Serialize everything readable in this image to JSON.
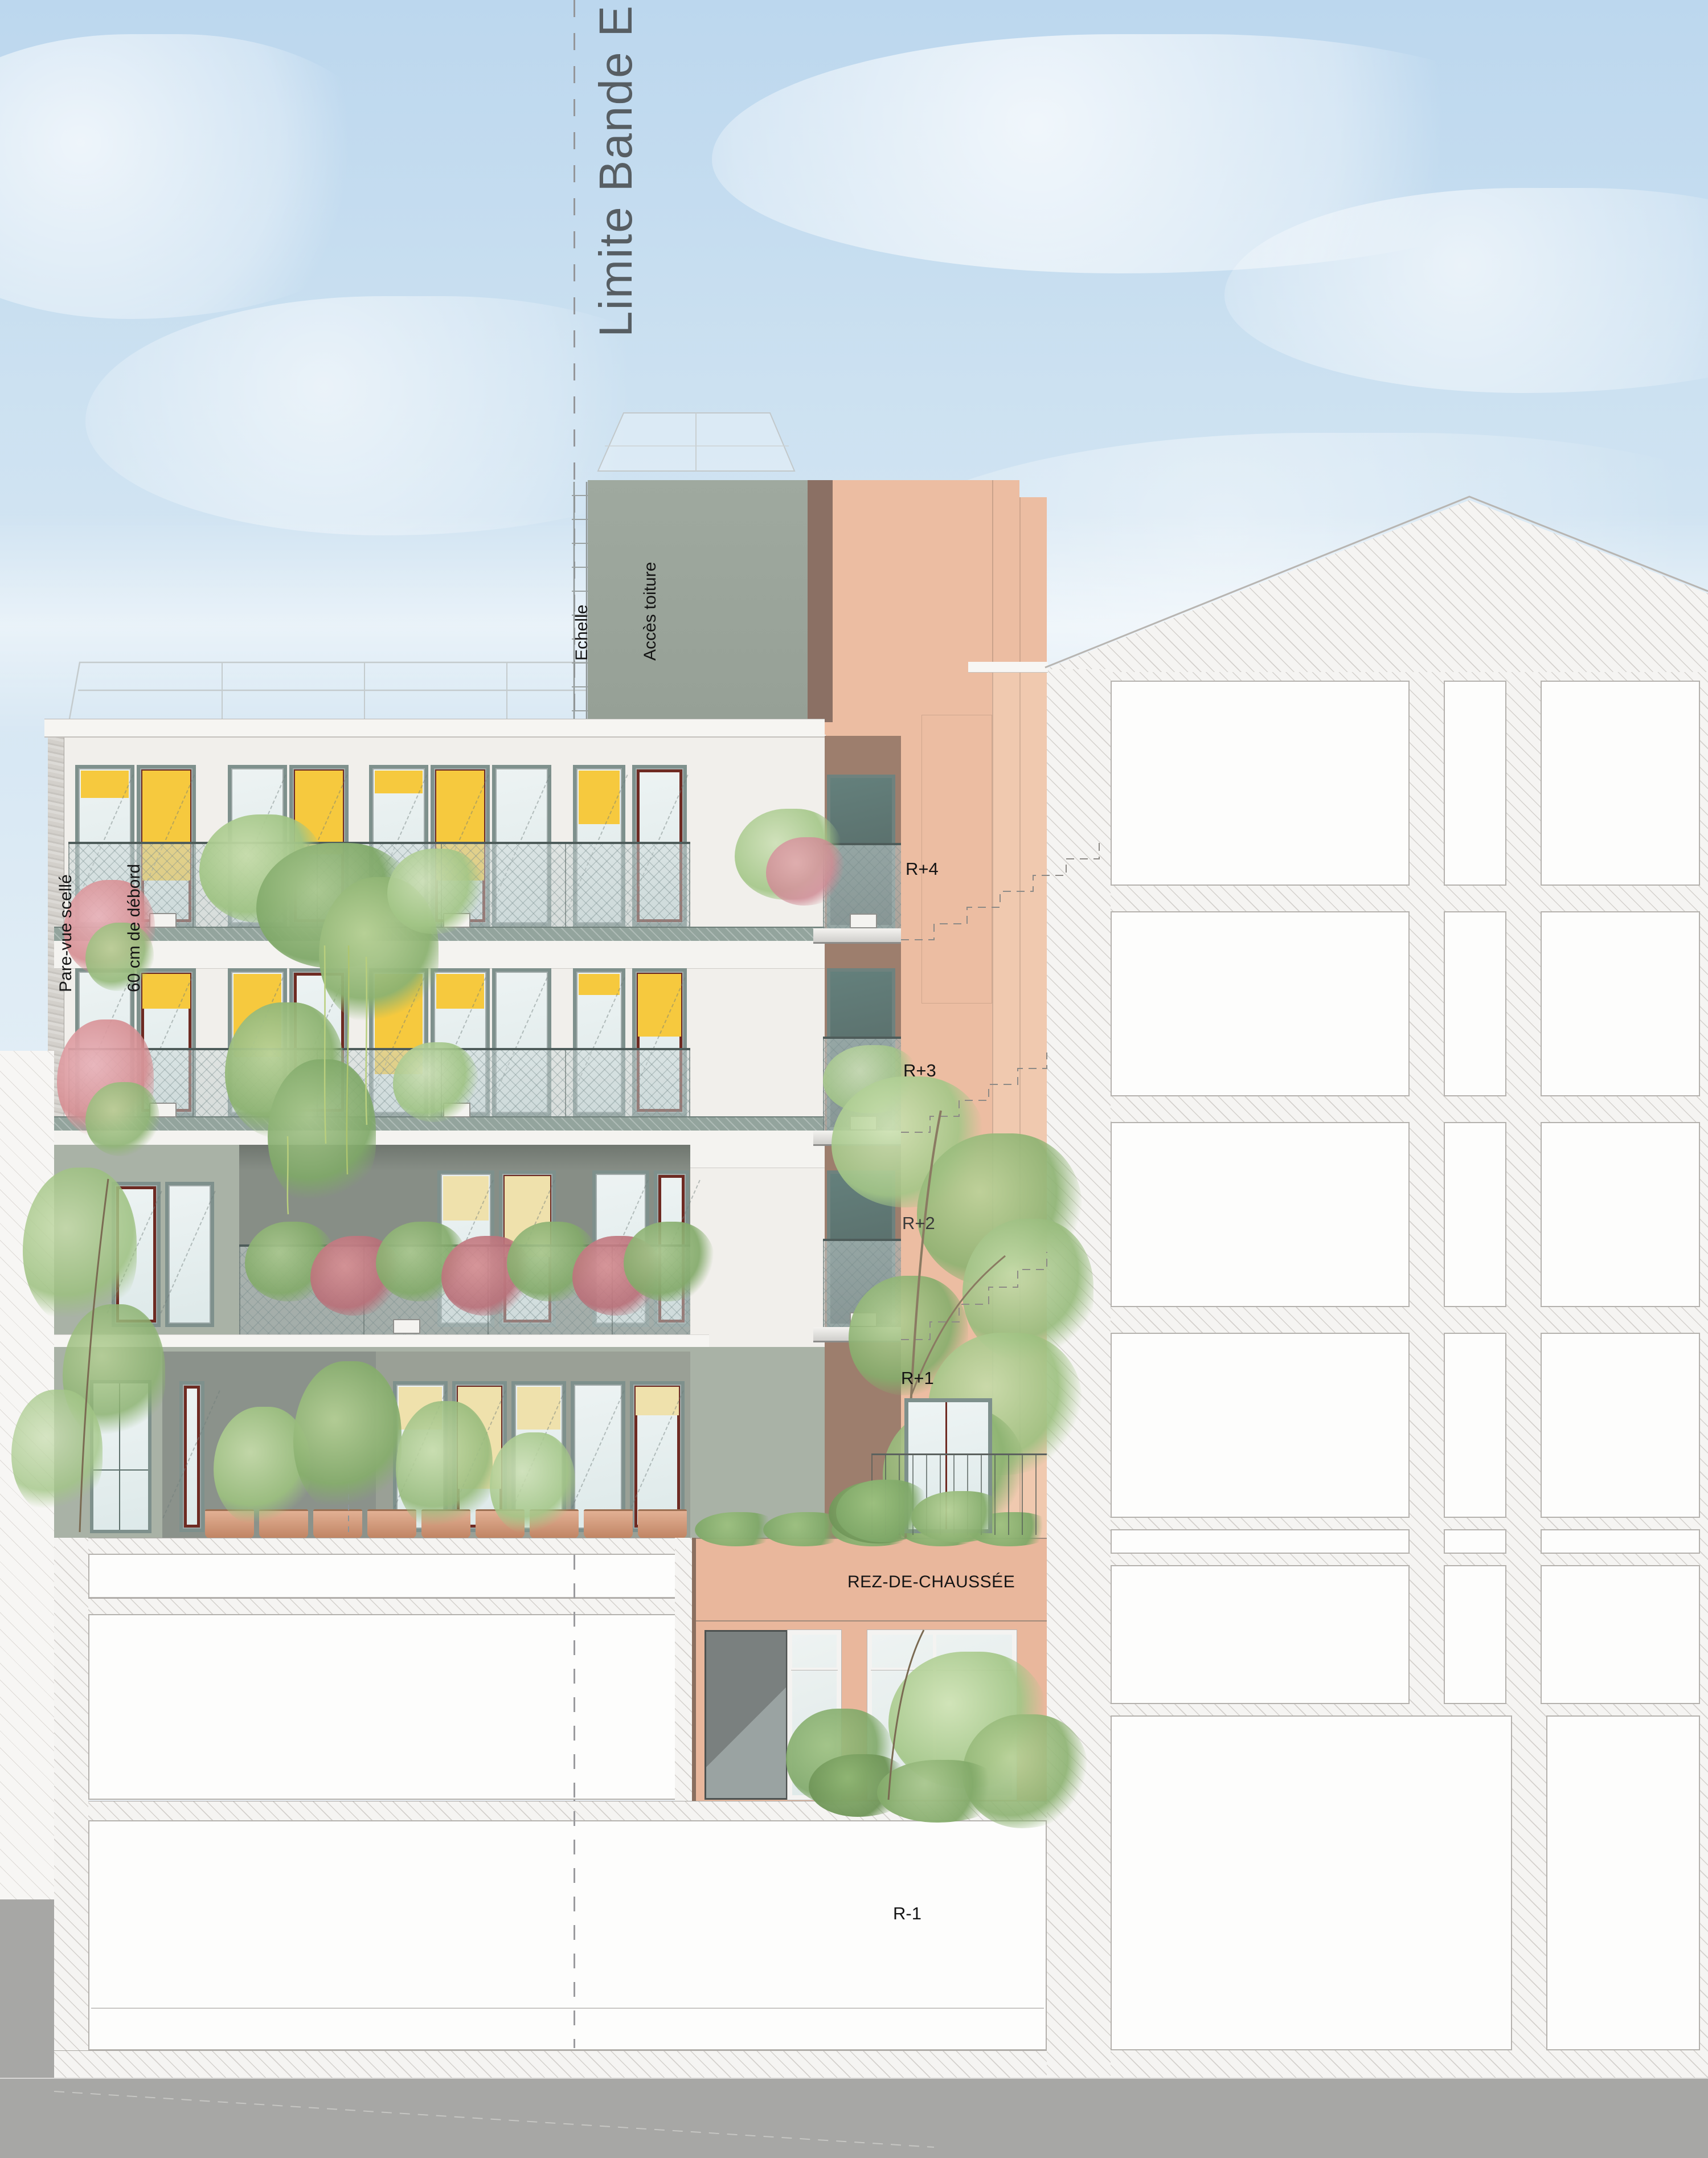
{
  "drawing": {
    "type": "architectural-facade-elevation",
    "annotations": {
      "limite_bande_e": "Limite Bande E",
      "echelle": "Echelle",
      "acces_toiture": "Accès toiture",
      "pare_vue": "Pare-vue scellé",
      "debord": "60 cm de débord"
    },
    "floor_labels": {
      "r_plus_4": "R+4",
      "r_plus_3": "R+3",
      "r_plus_2": "R+2",
      "r_plus_1": "R+1",
      "rdc": "REZ-DE-CHAUSSÉE",
      "r_minus_1": "R-1"
    },
    "colors": {
      "sky_top": "#bcd7ee",
      "sky_bottom": "#f2f6f8",
      "facade_white": "#f1efeb",
      "facade_green_gray": "#a9b2a6",
      "recess_gray": "#878e86",
      "window_frame": "#7e908c",
      "yellow_blind": "#f6c93e",
      "pale_yellow_blind": "#efe1ac",
      "dark_red_frame": "#6e2a22",
      "salmon_wall": "#ecbda2",
      "salmon_rdc": "#e9b79c",
      "roofbox_gray": "#9aa49b",
      "shadow_brown": "#9d7e6d",
      "terracotta_pot": "#d8a287",
      "ground_gray": "#a7a7a5",
      "hatch_line": "#d3d0cc",
      "foliage_green": "#a3c687",
      "flower_pink": "#e8a3ad"
    }
  }
}
